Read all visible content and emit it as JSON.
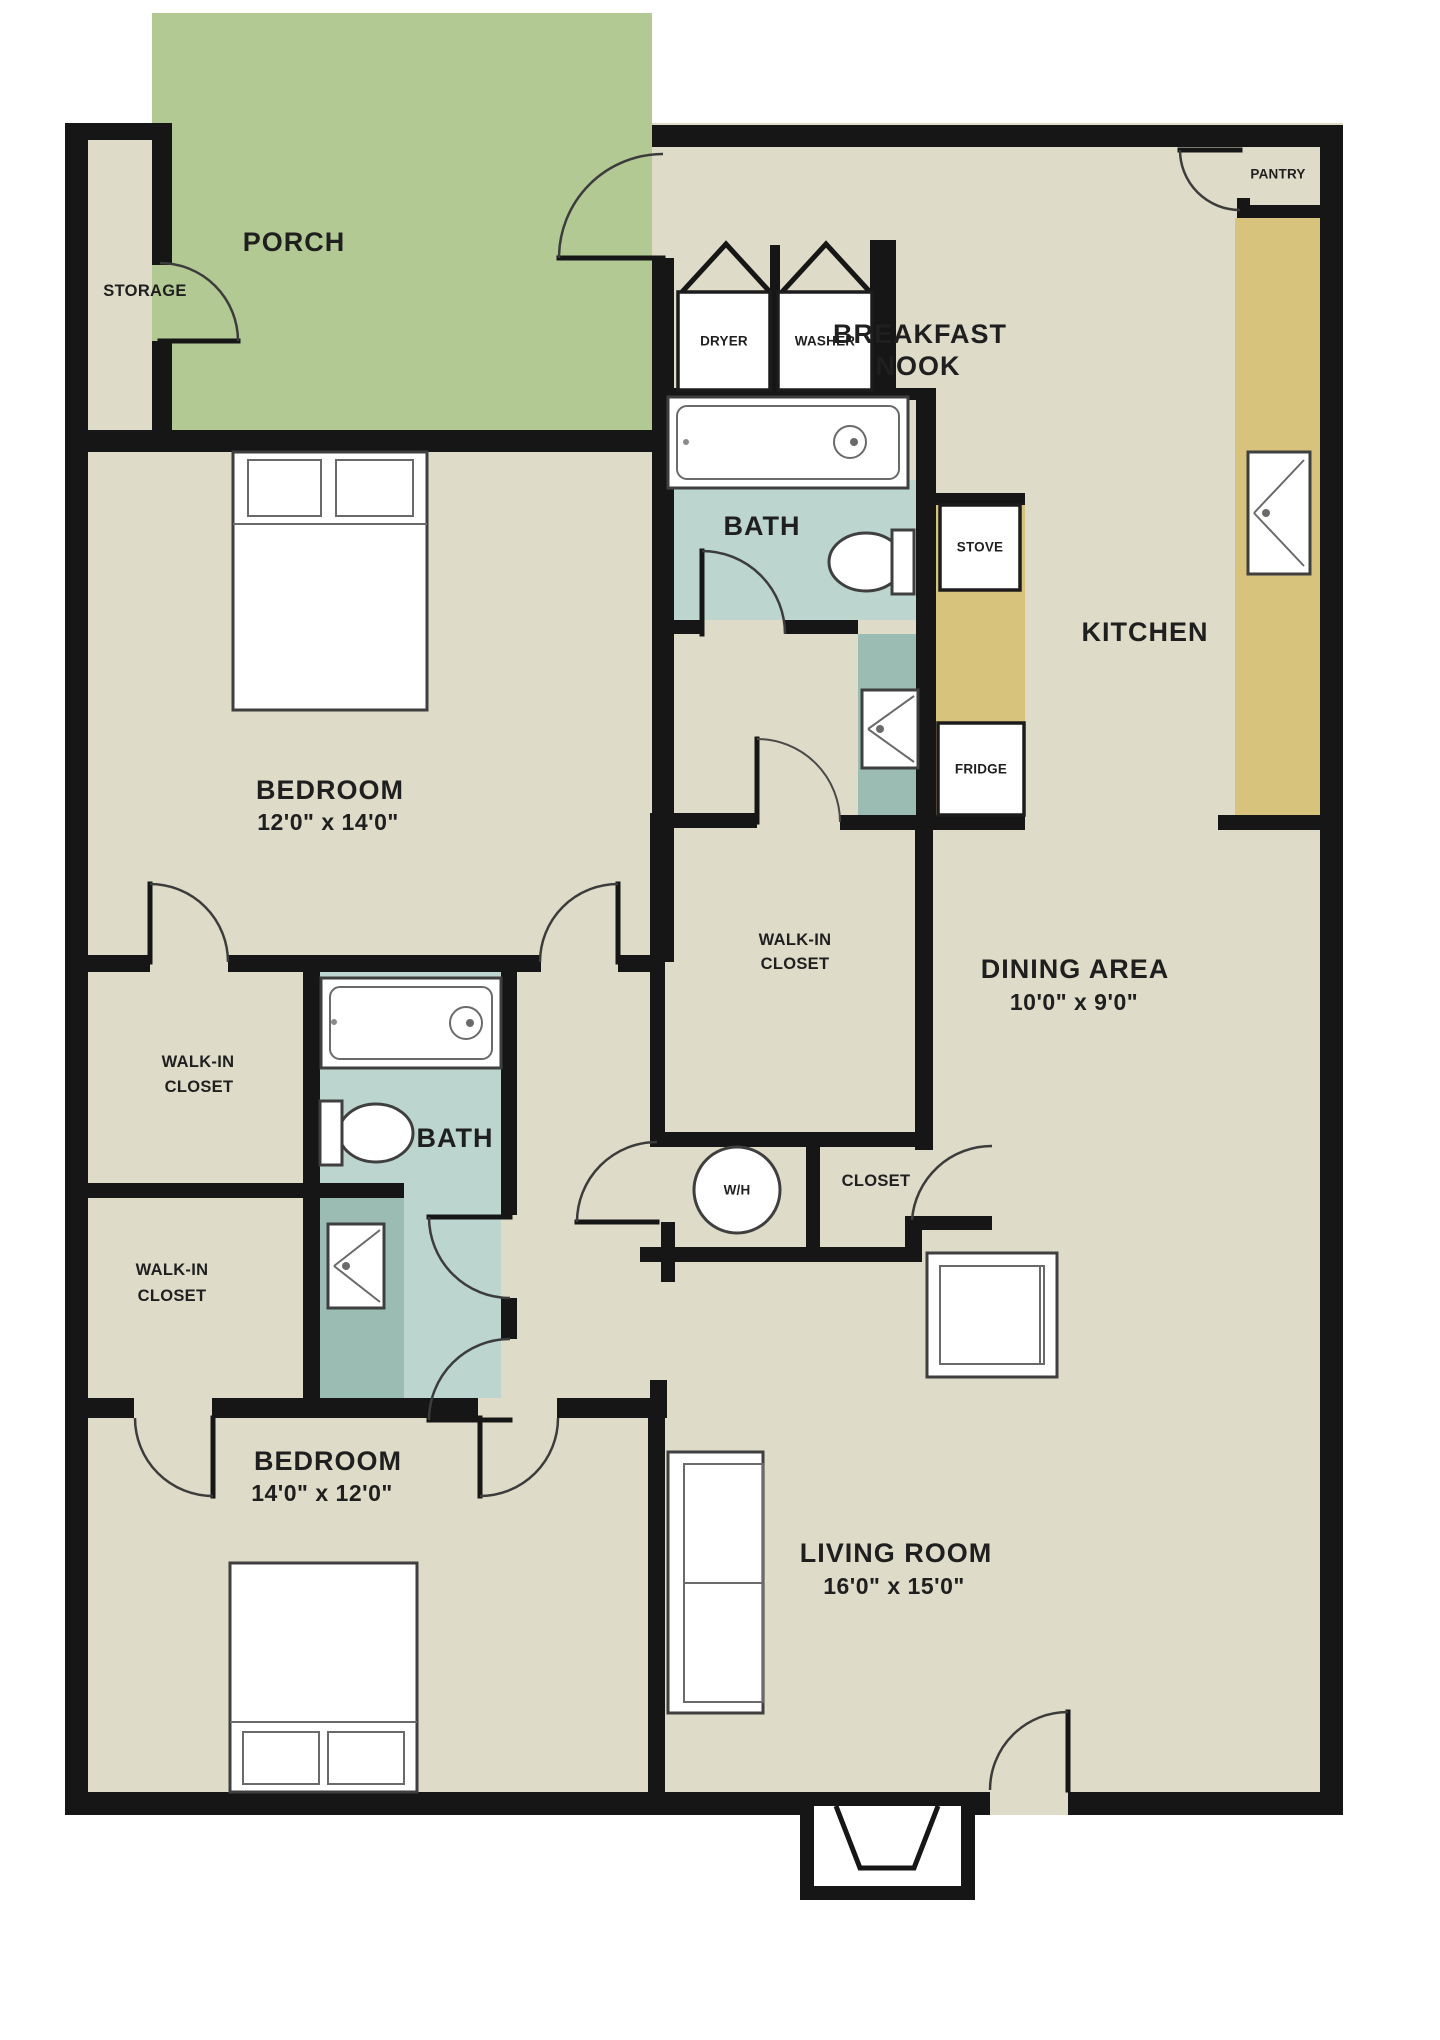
{
  "fp": {
    "type": "apartment-floor-plan",
    "colors": {
      "wall": "#161616",
      "floor": "#dedbc8",
      "porch": "#b3c994",
      "bath": "#bcd5ce",
      "vanity": "#9abcb3",
      "counter": "#d8c37c",
      "fixture_fill": "#ffffff",
      "label_text": "#1f1f1f"
    },
    "rooms": {
      "porch": {
        "name": "PORCH"
      },
      "storage": {
        "name": "STORAGE"
      },
      "breakfast_nook": {
        "line1": "BREAKFAST",
        "line2": "NOOK"
      },
      "pantry": {
        "name": "PANTRY"
      },
      "kitchen": {
        "name": "KITCHEN"
      },
      "dining_area": {
        "name": "DINING AREA",
        "dims": "10'0\" x 9'0\""
      },
      "bedroom_top": {
        "name": "BEDROOM",
        "dims": "12'0\" x 14'0\""
      },
      "bedroom_bottom": {
        "name": "BEDROOM",
        "dims": "14'0\" x 12'0\""
      },
      "living_room": {
        "name": "LIVING ROOM",
        "dims": "16'0\" x 15'0\""
      },
      "bath_top": {
        "name": "BATH"
      },
      "bath_bottom": {
        "name": "BATH"
      },
      "walk_in_closet_left_upper": {
        "line1": "WALK-IN",
        "line2": "CLOSET"
      },
      "walk_in_closet_left_lower": {
        "line1": "WALK-IN",
        "line2": "CLOSET"
      },
      "walk_in_closet_center": {
        "line1": "WALK-IN",
        "line2": "CLOSET"
      },
      "closet": {
        "name": "CLOSET"
      },
      "water_heater": {
        "name": "W/H"
      }
    },
    "appliances": {
      "dryer": "DRYER",
      "washer": "WASHER",
      "stove": "STOVE",
      "fridge": "FRIDGE"
    }
  }
}
